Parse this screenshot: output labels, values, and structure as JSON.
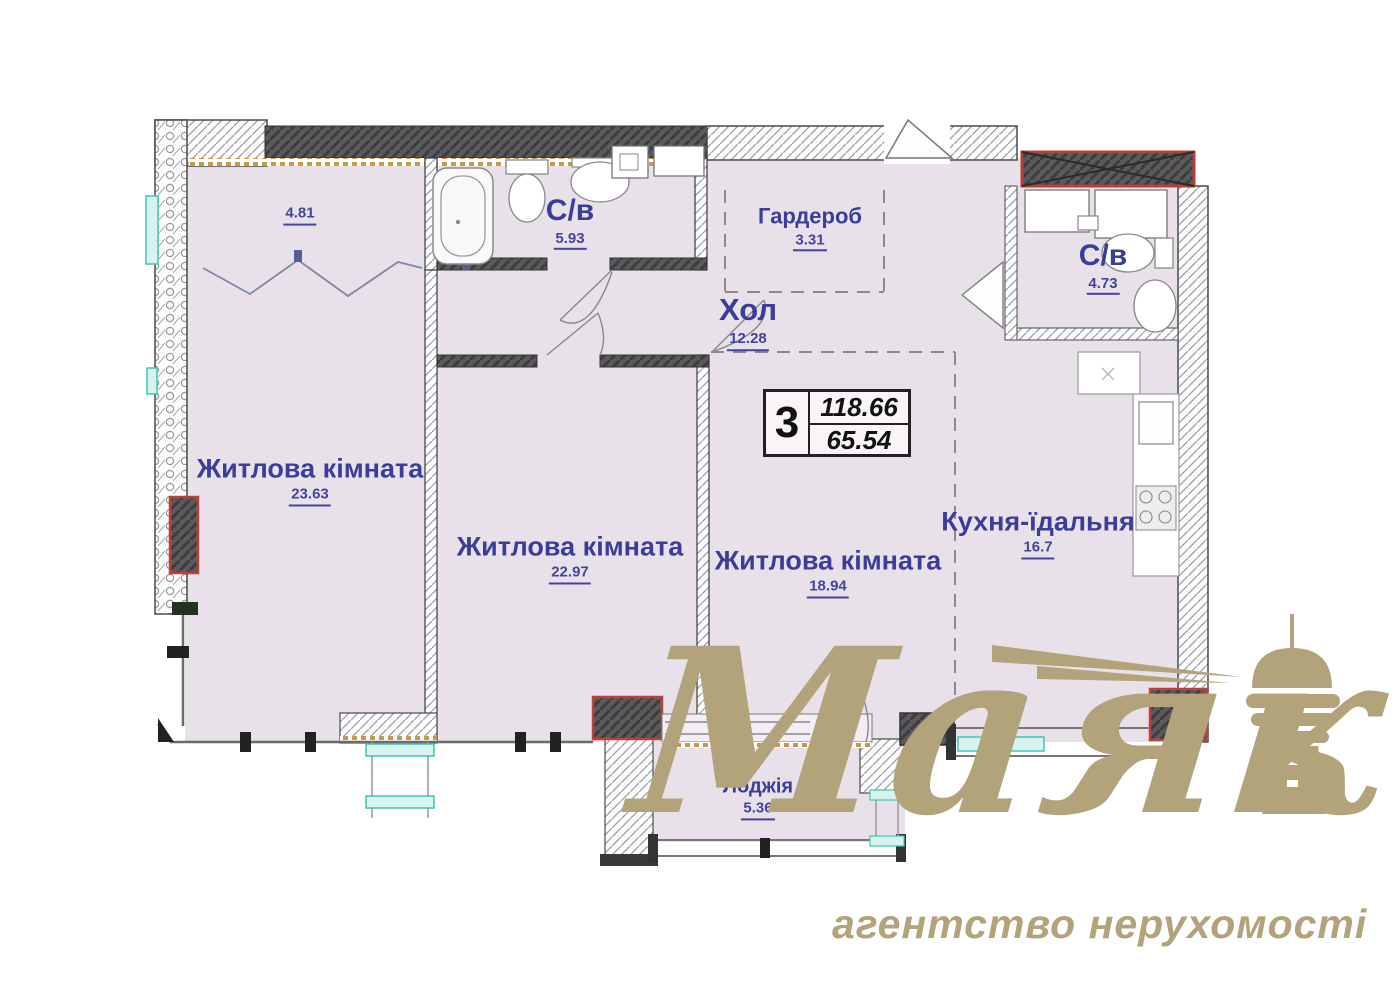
{
  "plan": {
    "rooms": [
      {
        "id": "balcony-top",
        "name": "",
        "area": "4.81"
      },
      {
        "id": "bathroom-1",
        "name": "С/в",
        "area": "5.93"
      },
      {
        "id": "wardrobe",
        "name": "Гардероб",
        "area": "3.31"
      },
      {
        "id": "hall",
        "name": "Хол",
        "area": "12.28"
      },
      {
        "id": "bathroom-2",
        "name": "С/в",
        "area": "4.73"
      },
      {
        "id": "living-room-1",
        "name": "Житлова кімната",
        "area": "23.63"
      },
      {
        "id": "living-room-2",
        "name": "Житлова кімната",
        "area": "22.97"
      },
      {
        "id": "living-room-3",
        "name": "Житлова кімната",
        "area": "18.94"
      },
      {
        "id": "kitchen-dining",
        "name": "Кухня-їдальня",
        "area": "16.7"
      },
      {
        "id": "loggia",
        "name": "Лоджія",
        "area": "5.36"
      }
    ],
    "info_box": {
      "rooms_count": "3",
      "total_area": "118.66",
      "living_area": "65.54"
    }
  },
  "watermark": {
    "brand": "Маяк",
    "tagline": "агентство нерухомості"
  },
  "colors": {
    "label_navy": "#3c3c99",
    "watermark_tan": "#b2a37b",
    "shaft_red": "#bf4038",
    "window_teal": "#3fc8b4",
    "floor_fill": "#e9e1e9"
  }
}
